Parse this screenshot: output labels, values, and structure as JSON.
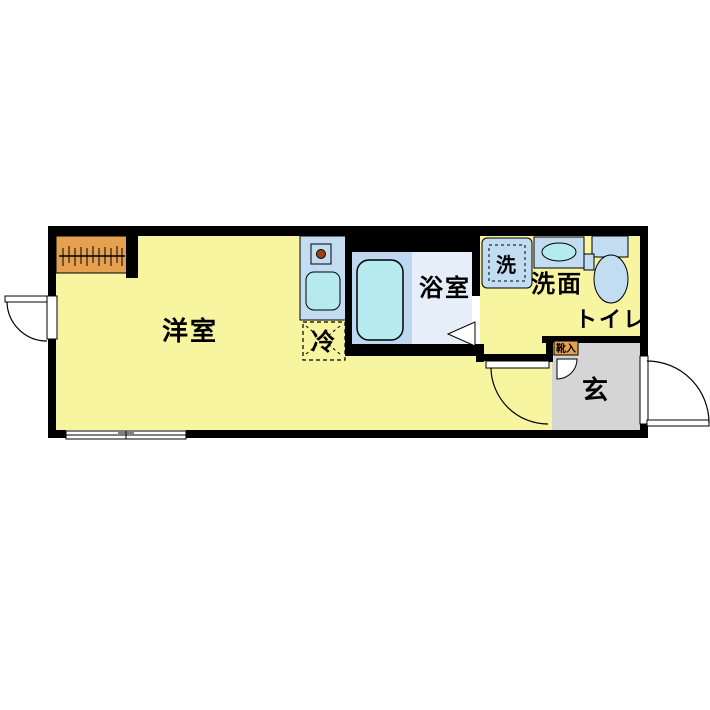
{
  "floorplan": {
    "labels": {
      "living_room": "洋室",
      "bathroom": "浴室",
      "vanity": "洗面",
      "washer": "洗",
      "toilet": "トイレ",
      "entrance": "玄",
      "refrigerator": "冷",
      "shoe_cabinet": "靴入"
    },
    "colors": {
      "room_yellow": "#F7F5A0",
      "closet_orange": "#E5A14F",
      "fixture_blue": "#C2DCF2",
      "water_cyan": "#B5EAEE",
      "bath_platform": "#BED8F2",
      "bath_floor": "#E6EEFA",
      "entrance_gray": "#D5D5D5",
      "wall_black": "#000000",
      "burner_brown": "#A04010",
      "paper_white": "#FFFFFF"
    }
  }
}
